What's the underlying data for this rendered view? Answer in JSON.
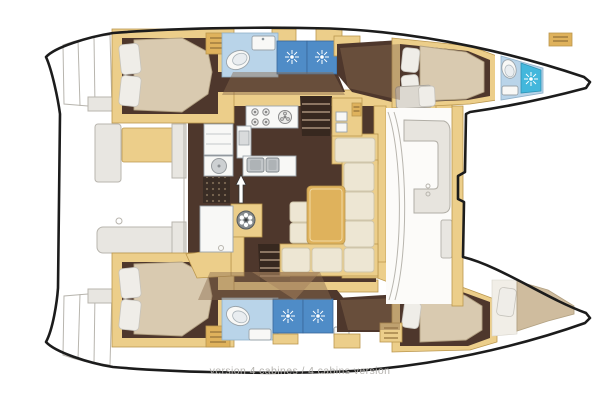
{
  "caption": {
    "text": "version 4 cabines / 4 cabins version"
  },
  "colors": {
    "background": "#ffffff",
    "outline": "#1c1c1c",
    "gray_line": "#b8b5ae",
    "gray_fill": "#e8e6e1",
    "hull_floor": "#4e372c",
    "floor_overlay": "#8a6a4e",
    "tan": "#ecce8a",
    "tan_dark": "#dfb25c",
    "tan_edge": "#bb974e",
    "mattress": "#d9cab0",
    "mattress_edge": "#b3a283",
    "cushion": "#ede6d3",
    "cushion_edge": "#cfc5aa",
    "pillow": "#efede8",
    "bath_floor": "#b9d4e9",
    "bath_edge": "#8fb0c9",
    "shower_blue": "#4f8cc7",
    "shower_cyan": "#43b7dc",
    "white_fixture": "#f8f8f6",
    "steps_dark": "#37281f",
    "caption_gray": "#b4b2ae"
  },
  "icons": {
    "shower_drain_icon": "white sunburst on blue tile",
    "toilet_icon": "white oval bowl",
    "sink_icon": "white basin with tap",
    "stove_icon": "four gas burners plus round element",
    "galley_sink_icon": "twin steel basins",
    "stairs_icon": "tread lines down to hull",
    "hatch_wheel_icon": "spoked wheel",
    "companionway_arrow_icon": "white up arrow",
    "locker_icon": "slatted cabinet front",
    "windlass_icon": "slatted deck box"
  }
}
